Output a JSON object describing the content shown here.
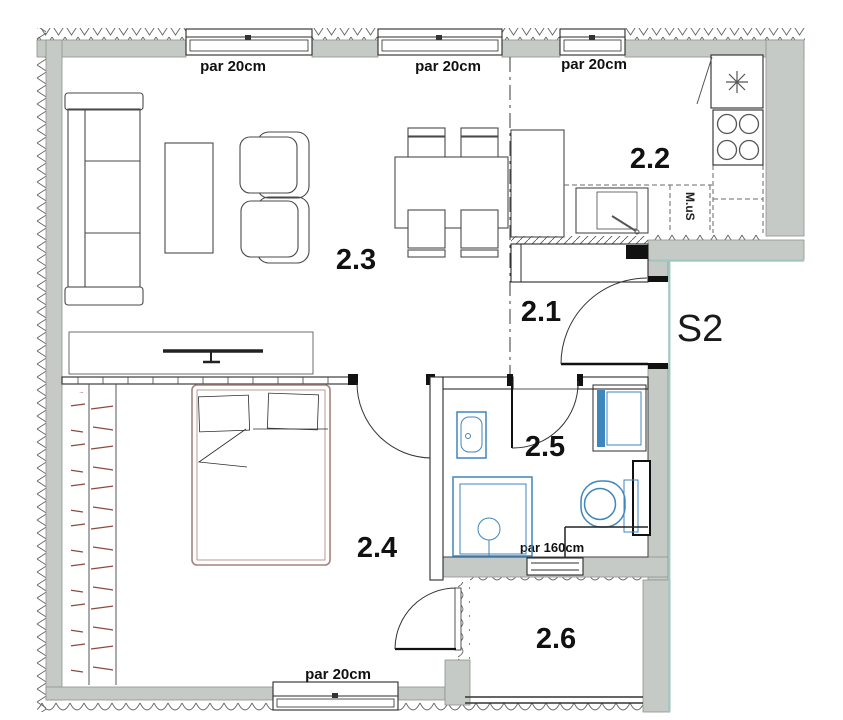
{
  "unit": {
    "label": "S2"
  },
  "rooms": [
    {
      "number": "2.1"
    },
    {
      "number": "2.2"
    },
    {
      "number": "2.3"
    },
    {
      "number": "2.4"
    },
    {
      "number": "2.5"
    },
    {
      "number": "2.6"
    }
  ],
  "annotations": {
    "window_top_left": "par 20cm",
    "window_top_middle": "par 20cm",
    "window_top_right": "par 20cm",
    "window_bottom": "par 20cm",
    "window_bathroom": "par 160cm",
    "kitchen_sink_unit": "M.uS"
  },
  "colors": {
    "wall": "#c6cac6",
    "wall_edge": "#8d928d",
    "furniture": "#4a4a4a",
    "fixture_blue": "#3f86bd",
    "fixture_blue_light": "#e8f1f8",
    "bed": "#a5837c",
    "hanger": "#8a4a3c",
    "accent_teal": "#9fc8be",
    "label": "#111111"
  }
}
